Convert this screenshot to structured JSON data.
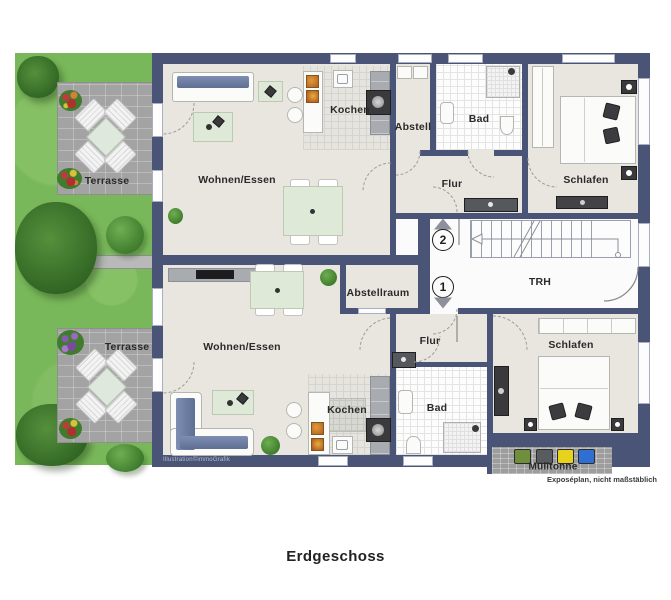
{
  "meta": {
    "floor_title": "Erdgeschoss",
    "credit": "Illustration©immoGrafik",
    "disclaimer": "Exposéplan, nicht maßstäblich"
  },
  "outdoor": {
    "terrace_upper": "Terrasse",
    "terrace_lower": "Terrasse",
    "bins_label": "Mülltonne"
  },
  "stairwell": {
    "label": "TRH",
    "upper_marker": "2",
    "lower_marker": "1"
  },
  "apartment_upper": {
    "living": "Wohnen/Essen",
    "kitchen": "Kochen",
    "storage": "Abstell",
    "bath": "Bad",
    "hall": "Flur",
    "bedroom": "Schlafen"
  },
  "apartment_lower": {
    "living": "Wohnen/Essen",
    "kitchen": "Kochen",
    "storage": "Abstellraum",
    "bath": "Bad",
    "hall": "Flur",
    "bedroom": "Schlafen"
  },
  "colors": {
    "wall": "#4a5476",
    "floor": "#e9e6e0",
    "garden": "#79b85a",
    "terrace": "#a3a3a3",
    "sofa_accent": "#6e7fa5",
    "bin_green": "#6f8f3d",
    "bin_gray": "#595c5f",
    "bin_yellow": "#e7d31d",
    "bin_blue": "#2f6fd1"
  }
}
